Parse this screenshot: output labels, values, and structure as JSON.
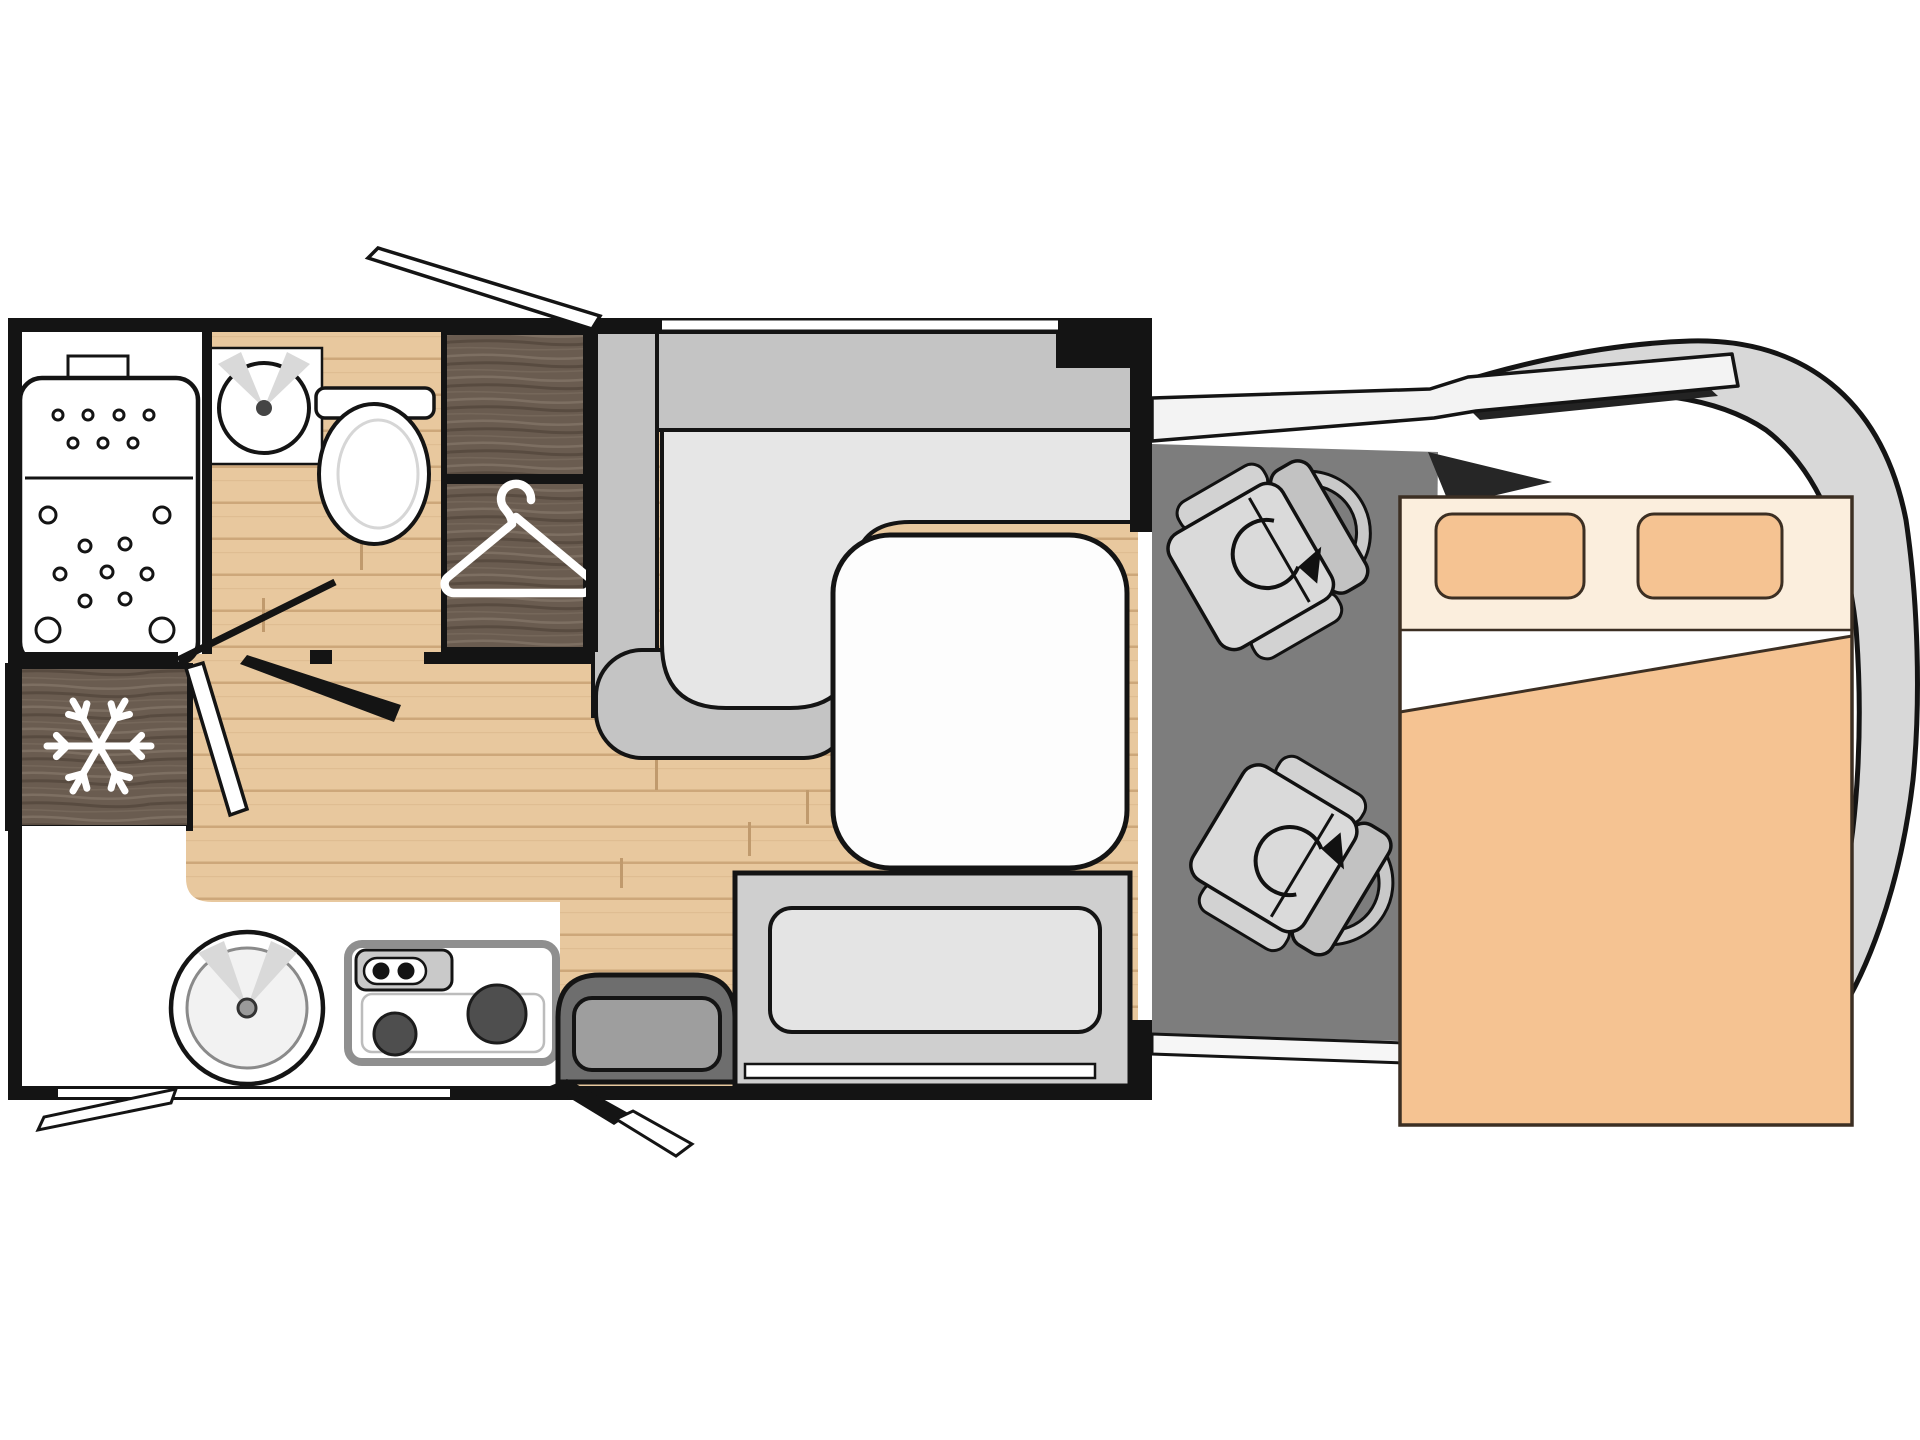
{
  "meta": {
    "title": "Motorhome floor plan (top view)",
    "diagram_type": "floorplan",
    "orientation": "vehicle nose on the right, habitation box on the left"
  },
  "areas": {
    "bathroom": "Bathroom with shower tray, round washbasin and toilet",
    "wardrobe": "Wardrobe cabinet with clothes-hanger symbol",
    "fridge": "Refrigerator with snowflake symbol",
    "kitchen": "Kitchen block with round sink and two-burner hob",
    "dinette": "L-shaped lounge seating with white table",
    "side_bench": "Side bench seat next to entrance door",
    "entry_step": "Entrance step",
    "cab": "Driver cab with two swivel seats",
    "bed": "Transverse double bed with two pillows and duvet",
    "vehicle_front": "Vehicle cab / bonnet outline"
  },
  "features": {
    "snowflake_icon": "fridge snowflake",
    "hanger_icon": "wardrobe clothes hanger",
    "swivel_arrows": "rotation arrows on both cab seats",
    "door_markers": "open door / window swing markers on walls",
    "pillow_count": 2,
    "burner_count": 2,
    "cab_seat_count": 2
  },
  "colors": {
    "wall": "#141414",
    "wood_floor": "#e8c89e",
    "wood_line": "#cda77a",
    "dark_wood": "#6a5c50",
    "seat_gray": "#c4c4c4",
    "cushion_gray": "#e4e4e4",
    "cab_floor": "#7d7d7d",
    "body_gray": "#d8d8d8",
    "bed_peach": "#f5c392",
    "bed_cream": "#fbeedd",
    "white": "#ffffff"
  }
}
